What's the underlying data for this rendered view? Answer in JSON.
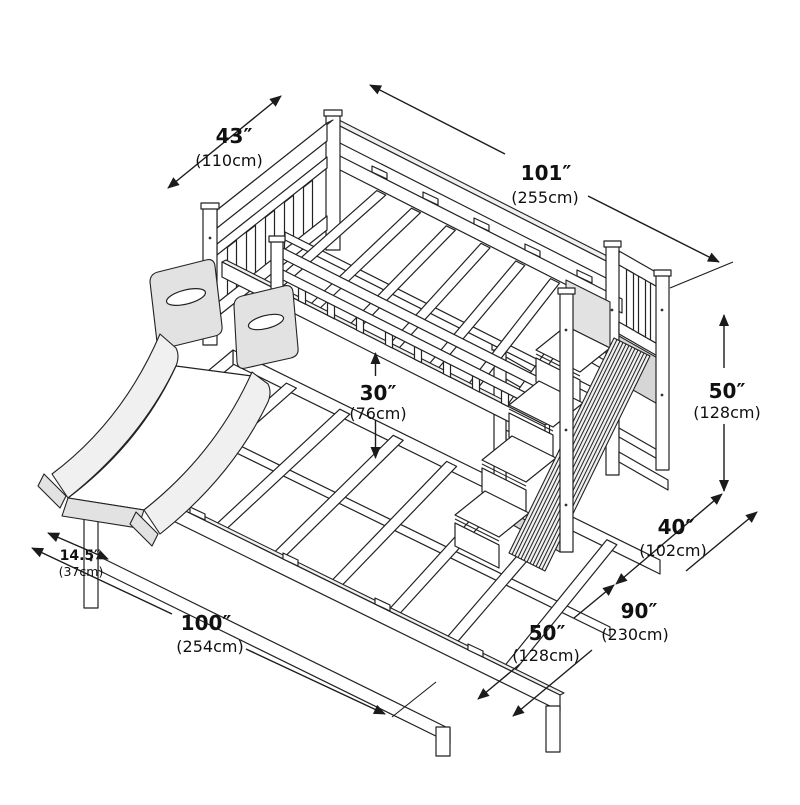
{
  "diagram": {
    "stroke_color": "#222222",
    "background": "#ffffff",
    "shade_light": "#f0f0f0",
    "shade_mid": "#e2e2e2",
    "dimensions": [
      {
        "id": "headboard-width",
        "inches": "43″",
        "metric": "(110cm)"
      },
      {
        "id": "overall-length",
        "inches": "101″",
        "metric": "(255cm)"
      },
      {
        "id": "bunk-gap-height",
        "inches": "30″",
        "metric": "(76cm)"
      },
      {
        "id": "overall-height",
        "inches": "50″",
        "metric": "(128cm)"
      },
      {
        "id": "staircase-depth",
        "inches": "40″",
        "metric": "(102cm)"
      },
      {
        "id": "slide-width",
        "inches": "14.5″",
        "metric": "(37cm)"
      },
      {
        "id": "length-with-slide",
        "inches": "100″",
        "metric": "(254cm)"
      },
      {
        "id": "bed-width",
        "inches": "50″",
        "metric": "(128cm)"
      },
      {
        "id": "footprint-with-stairs",
        "inches": "90″",
        "metric": "(230cm)"
      }
    ]
  }
}
